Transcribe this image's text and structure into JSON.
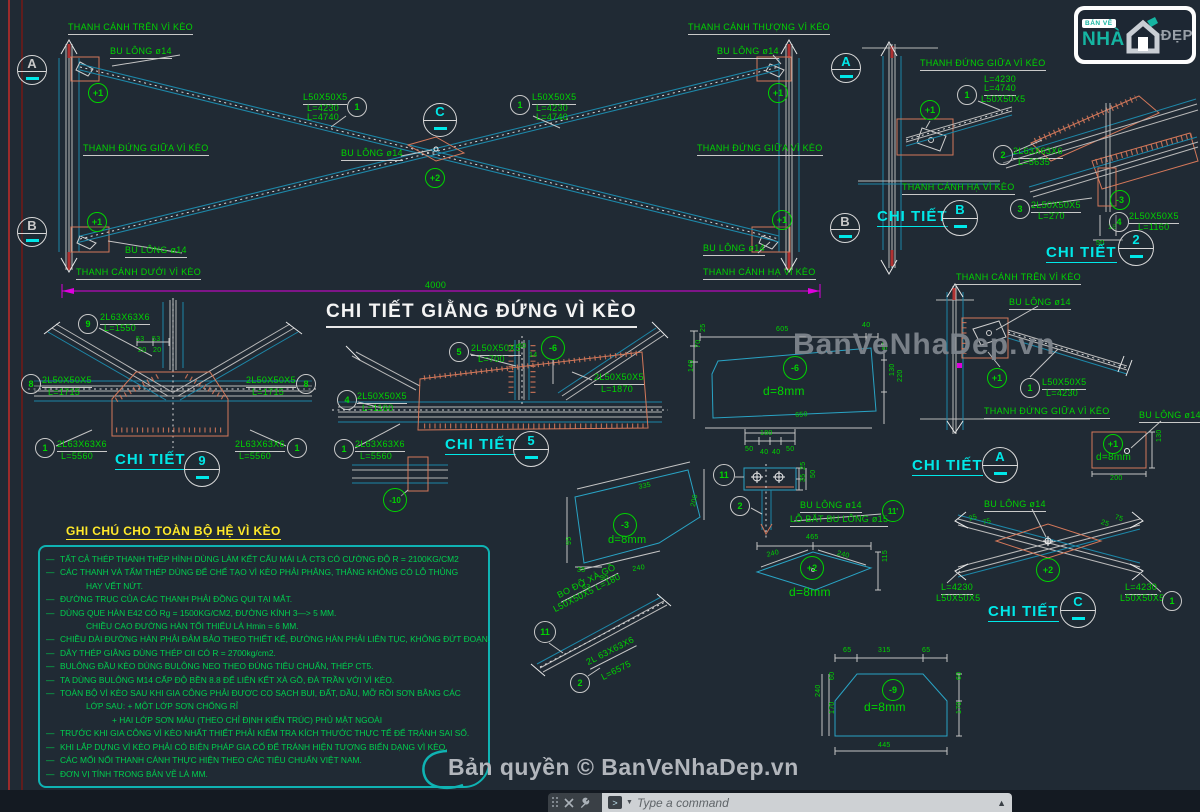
{
  "title": "CHI TIẾT GIẰNG ĐỨNG VÌ KÈO",
  "branding": {
    "watermark": "BanVeNhaDep.vn",
    "copyright": "Bản quyền © BanVeNhaDep.vn",
    "logo": {
      "line1": "BẢN VẼ",
      "line2": "NHÀ",
      "line3": "ĐẸP"
    }
  },
  "app": {
    "command_placeholder": "Type a command"
  },
  "colors": {
    "green": "#00d400",
    "cyan": "#00e8e8",
    "yellow": "#ffe92a",
    "salmon": "#d4785a",
    "magenta": "#e000e0",
    "gray": "#c9c9c9",
    "teal_box": "#0fb3b3",
    "red": "#b13232"
  },
  "notes": {
    "heading": "GHI CHÚ CHO TOÀN BỘ HỆ VÌ KÈO",
    "lines": [
      {
        "d": 1,
        "i": 0,
        "t": "TẤT CẢ THÉP THANH THÉP HÌNH DÙNG LÀM KẾT CẤU MÁI  LÀ CT3 CÓ CƯỜNG ĐỘ R = 2100KG/CM2"
      },
      {
        "d": 1,
        "i": 0,
        "t": "CÁC THANH VÀ TẤM THÉP DÙNG ĐỂ CHẾ TẠO VÌ KÈO PHẢI PHẲNG, THẲNG KHÔNG CÓ LỖ THỦNG"
      },
      {
        "d": 0,
        "i": 1,
        "t": "HAY VẾT NỨT."
      },
      {
        "d": 1,
        "i": 0,
        "t": "ĐƯỜNG TRỤC CỦA CÁC THANH PHẢI ĐỒNG QUI TẠI MẮT."
      },
      {
        "d": 1,
        "i": 0,
        "t": "DÙNG QUE HÀN E42 CÓ Rg = 1500KG/CM2, ĐƯỜNG KÍNH 3—> 5 MM."
      },
      {
        "d": 0,
        "i": 1,
        "t": "CHIỀU CAO ĐƯỜNG HÀN TỐI THIỂU LÀ Hmin = 6 MM."
      },
      {
        "d": 1,
        "i": 0,
        "t": "CHIỀU DÀI ĐƯỜNG HÀN PHẢI ĐẢM BẢO THEO THIẾT KẾ, ĐƯỜNG HÀN PHẢI LIÊN TỤC, KHÔNG ĐỨT ĐOẠN."
      },
      {
        "d": 1,
        "i": 0,
        "t": "DÂY THÉP GIẰNG DÙNG THÉP CII CÓ R = 2700kg/cm2."
      },
      {
        "d": 1,
        "i": 0,
        "t": "BULÔNG ĐẦU KÈO DÙNG BULÔNG NEO THEO ĐÚNG TIÊU CHUẨN, THÉP CT5."
      },
      {
        "d": 1,
        "i": 0,
        "t": "TA DÙNG BULÔNG M14 CẤP ĐỘ BỀN 8.8 ĐỂ LIÊN KẾT XÀ GỒ, ĐÀ TRẦN VỚI VÌ KÈO."
      },
      {
        "d": 1,
        "i": 0,
        "t": "TOÀN BỘ VÌ KÈO SAU KHI GIA CÔNG PHẢI ĐƯỢC CỌ SẠCH BỤI, ĐẤT, DẦU, MỠ RỒI SƠN BẰNG CÁC"
      },
      {
        "d": 0,
        "i": 1,
        "t": "LỚP SAU:  + MỘT LỚP SƠN CHỐNG RỈ"
      },
      {
        "d": 0,
        "i": 2,
        "t": "+ HAI LỚP SƠN MÀU (THEO CHỈ ĐỊNH KIẾN TRÚC) PHỦ MẶT NGOÀI"
      },
      {
        "d": 1,
        "i": 0,
        "t": "TRƯỚC KHI GIA CÔNG VÌ KÈO NHẤT THIẾT PHẢI KIỂM TRA KÍCH THƯỚC THỰC TẾ ĐỂ TRÁNH SAI SỐ."
      },
      {
        "d": 1,
        "i": 0,
        "t": "KHI LẮP DỰNG VÌ KÈO PHẢI CÓ BIỆN PHÁP GIA CỐ ĐỂ TRÁNH HIỆN TƯỢNG BIẾN DẠNG VÌ KÈO."
      },
      {
        "d": 1,
        "i": 0,
        "t": "CÁC MỐI NỐI THANH CÁNH THỰC HIỆN THEO CÁC TIÊU CHUẨN VIỆT NAM."
      },
      {
        "d": 1,
        "i": 0,
        "t": "ĐƠN VỊ TÍNH TRONG BẢN VẼ LÀ MM."
      }
    ]
  },
  "labels": [
    {
      "t": "THANH CÁNH TRÊN VÌ KÈO",
      "x": 68,
      "y": 23,
      "u": 1
    },
    {
      "t": "BU LÔNG ø14",
      "x": 110,
      "y": 47,
      "u": 1
    },
    {
      "t": "L50X50X5",
      "x": 303,
      "y": 93,
      "u": 1
    },
    {
      "t": "L=4230",
      "x": 307,
      "y": 104
    },
    {
      "t": "L=4740",
      "x": 307,
      "y": 113
    },
    {
      "t": "THANH ĐỨNG GIỮA VÌ KÈO",
      "x": 83,
      "y": 144,
      "u": 1
    },
    {
      "t": "BU LÔNG ø14",
      "x": 341,
      "y": 149,
      "u": 1
    },
    {
      "t": "BU LÔNG ø14",
      "x": 125,
      "y": 246,
      "u": 1
    },
    {
      "t": "THANH CÁNH DƯỚI VÌ KÈO",
      "x": 76,
      "y": 268,
      "u": 1
    },
    {
      "t": "THANH CÁNH THƯỢNG VÌ KÈO",
      "x": 688,
      "y": 23,
      "u": 1
    },
    {
      "t": "BU LÔNG ø14",
      "x": 717,
      "y": 47,
      "u": 1
    },
    {
      "t": "L50X50X5",
      "x": 532,
      "y": 93,
      "u": 1
    },
    {
      "t": "L=4230",
      "x": 536,
      "y": 104
    },
    {
      "t": "L=4740",
      "x": 536,
      "y": 113
    },
    {
      "t": "THANH ĐỨNG GIỮA VÌ KÈO",
      "x": 697,
      "y": 144,
      "u": 1
    },
    {
      "t": "BU LÔNG ø14",
      "x": 703,
      "y": 244,
      "u": 1
    },
    {
      "t": "THANH CÁNH HẠ VÌ KÈO",
      "x": 703,
      "y": 268,
      "u": 1
    },
    {
      "t": "4000",
      "x": 425,
      "y": 281
    },
    {
      "t": "THANH ĐỨNG GIỮA VÌ KÈO",
      "x": 920,
      "y": 59,
      "u": 1
    },
    {
      "t": "L=4230",
      "x": 984,
      "y": 75
    },
    {
      "t": "L=4740",
      "x": 984,
      "y": 84,
      "u": 1
    },
    {
      "t": "L50X50X5",
      "x": 981,
      "y": 95
    },
    {
      "t": "THANH CÁNH HẠ VÌ KÈO",
      "x": 902,
      "y": 183,
      "u": 1
    },
    {
      "t": "CHI TIẾT",
      "x": 877,
      "y": 209,
      "c": "cy",
      "s": 15,
      "b": 1,
      "u": 2
    },
    {
      "t": "2L63X63X6",
      "x": 1013,
      "y": 147,
      "u": 1
    },
    {
      "t": "L=5635",
      "x": 1018,
      "y": 158
    },
    {
      "t": "2L50X50X5",
      "x": 1031,
      "y": 201,
      "u": 1
    },
    {
      "t": "L=270",
      "x": 1038,
      "y": 212
    },
    {
      "t": "2L50X50X5",
      "x": 1129,
      "y": 212,
      "u": 1
    },
    {
      "t": "L=1160",
      "x": 1138,
      "y": 223
    },
    {
      "t": "18",
      "x": 1108,
      "y": 224,
      "s": 7
    },
    {
      "t": "50",
      "x": 1096,
      "y": 240,
      "s": 7
    },
    {
      "t": "CHI TIẾT",
      "x": 1046,
      "y": 245,
      "c": "cy",
      "s": 15,
      "b": 1,
      "u": 2
    },
    {
      "t": "2L63X63X6",
      "x": 100,
      "y": 313,
      "u": 1
    },
    {
      "t": "L=1550",
      "x": 104,
      "y": 324
    },
    {
      "t": "53",
      "x": 136,
      "y": 336,
      "s": 7
    },
    {
      "t": "53",
      "x": 152,
      "y": 336,
      "s": 7
    },
    {
      "t": "20",
      "x": 138,
      "y": 347,
      "s": 7
    },
    {
      "t": "20",
      "x": 153,
      "y": 347,
      "s": 7
    },
    {
      "t": "2L50X50X5",
      "x": 42,
      "y": 376,
      "u": 1
    },
    {
      "t": "L=1715",
      "x": 48,
      "y": 388
    },
    {
      "t": "2L50X50X5",
      "x": 246,
      "y": 376,
      "u": 1
    },
    {
      "t": "L=1715",
      "x": 252,
      "y": 388
    },
    {
      "t": "2L63X63X6",
      "x": 57,
      "y": 440,
      "u": 1
    },
    {
      "t": "L=5560",
      "x": 61,
      "y": 452
    },
    {
      "t": "2L63X63X6",
      "x": 235,
      "y": 440,
      "u": 1
    },
    {
      "t": "L=5560",
      "x": 239,
      "y": 452
    },
    {
      "t": "CHI TIẾT",
      "x": 115,
      "y": 452,
      "c": "cy",
      "s": 15,
      "b": 1,
      "u": 2
    },
    {
      "t": "2L50X50X5",
      "x": 471,
      "y": 344,
      "u": 1
    },
    {
      "t": "L=700",
      "x": 478,
      "y": 355
    },
    {
      "t": "2L50X50X5",
      "x": 594,
      "y": 373,
      "u": 1
    },
    {
      "t": "L=1870",
      "x": 601,
      "y": 385
    },
    {
      "t": "2L50X50X5",
      "x": 357,
      "y": 392,
      "u": 1
    },
    {
      "t": "L=1160",
      "x": 362,
      "y": 404
    },
    {
      "t": "2L63X63X6",
      "x": 355,
      "y": 440,
      "u": 1
    },
    {
      "t": "L=5560",
      "x": 360,
      "y": 452
    },
    {
      "t": "CHI TIẾT",
      "x": 445,
      "y": 437,
      "c": "cy",
      "s": 15,
      "b": 1,
      "u": 2
    },
    {
      "t": "60",
      "x": 518,
      "y": 343,
      "s": 7
    },
    {
      "t": "14",
      "x": 529,
      "y": 352,
      "s": 7
    },
    {
      "t": "d=8mm",
      "x": 608,
      "y": 535,
      "s": 11
    },
    {
      "t": "335",
      "x": 638,
      "y": 484,
      "s": 7,
      "r": -11
    },
    {
      "t": "240",
      "x": 632,
      "y": 566,
      "s": 7,
      "r": -9
    },
    {
      "t": "90",
      "x": 600,
      "y": 575,
      "s": 7
    },
    {
      "t": "35",
      "x": 577,
      "y": 567,
      "s": 7
    },
    {
      "t": "63",
      "x": 582,
      "y": 584,
      "s": 7
    },
    {
      "t": "95",
      "x": 566,
      "y": 545,
      "s": 7,
      "r": -90
    },
    {
      "t": "200",
      "x": 690,
      "y": 506,
      "s": 7,
      "r": -78
    },
    {
      "t": "BO ĐỠ XÀ GỒ",
      "x": 556,
      "y": 592,
      "r": -27,
      "u": 1
    },
    {
      "t": "L50X50X5 L=180",
      "x": 552,
      "y": 606,
      "r": -27
    },
    {
      "t": "2L 63X63X6",
      "x": 585,
      "y": 659,
      "r": -27,
      "u": 1
    },
    {
      "t": "L=6575",
      "x": 600,
      "y": 674,
      "r": -27
    },
    {
      "t": "180",
      "x": 760,
      "y": 430,
      "s": 7
    },
    {
      "t": "50",
      "x": 745,
      "y": 446,
      "s": 7
    },
    {
      "t": "40",
      "x": 760,
      "y": 449,
      "s": 7
    },
    {
      "t": "40",
      "x": 772,
      "y": 449,
      "s": 7
    },
    {
      "t": "50",
      "x": 786,
      "y": 446,
      "s": 7
    },
    {
      "t": "25",
      "x": 800,
      "y": 470,
      "s": 7,
      "r": -90
    },
    {
      "t": "35",
      "x": 800,
      "y": 482,
      "s": 7,
      "r": -90
    },
    {
      "t": "50",
      "x": 810,
      "y": 478,
      "s": 7,
      "r": -90
    },
    {
      "t": "BU LÔNG ø14",
      "x": 800,
      "y": 501,
      "u": 1
    },
    {
      "t": "LỖ BẮT BU LÔNG ø15",
      "x": 790,
      "y": 515,
      "u": 1
    },
    {
      "t": "605",
      "x": 776,
      "y": 326,
      "s": 7
    },
    {
      "t": "40",
      "x": 862,
      "y": 322,
      "s": 7
    },
    {
      "t": "25",
      "x": 700,
      "y": 332,
      "s": 7,
      "r": -90
    },
    {
      "t": "70",
      "x": 695,
      "y": 348,
      "s": 7,
      "r": -90
    },
    {
      "t": "140",
      "x": 688,
      "y": 372,
      "s": 7,
      "r": -90
    },
    {
      "t": "55",
      "x": 882,
      "y": 350,
      "s": 7,
      "r": -90
    },
    {
      "t": "130",
      "x": 889,
      "y": 376,
      "s": 7,
      "r": -90
    },
    {
      "t": "220",
      "x": 897,
      "y": 382,
      "s": 7,
      "r": -90
    },
    {
      "t": "d=8mm",
      "x": 763,
      "y": 385,
      "s": 12
    },
    {
      "t": "650",
      "x": 795,
      "y": 412,
      "s": 7,
      "r": -4
    },
    {
      "t": "465",
      "x": 806,
      "y": 534,
      "s": 7
    },
    {
      "t": "240",
      "x": 766,
      "y": 552,
      "s": 7,
      "r": -14
    },
    {
      "t": "240",
      "x": 838,
      "y": 550,
      "s": 7,
      "r": 14
    },
    {
      "t": "115",
      "x": 882,
      "y": 562,
      "s": 7,
      "r": -90
    },
    {
      "t": "d=8mm",
      "x": 789,
      "y": 586,
      "s": 12
    },
    {
      "t": "65",
      "x": 843,
      "y": 647,
      "s": 7
    },
    {
      "t": "315",
      "x": 878,
      "y": 647,
      "s": 7
    },
    {
      "t": "65",
      "x": 922,
      "y": 647,
      "s": 7
    },
    {
      "t": "240",
      "x": 815,
      "y": 697,
      "s": 7,
      "r": -90
    },
    {
      "t": "60",
      "x": 829,
      "y": 680,
      "s": 7,
      "r": -90
    },
    {
      "t": "170",
      "x": 829,
      "y": 714,
      "s": 7,
      "r": -90
    },
    {
      "t": "60",
      "x": 956,
      "y": 680,
      "s": 7,
      "r": -90
    },
    {
      "t": "170",
      "x": 956,
      "y": 714,
      "s": 7,
      "r": -90
    },
    {
      "t": "445",
      "x": 878,
      "y": 742,
      "s": 7
    },
    {
      "t": "d=8mm",
      "x": 864,
      "y": 701,
      "s": 12
    },
    {
      "t": "THANH CÁNH TRÊN VÌ KÈO",
      "x": 956,
      "y": 273,
      "u": 1
    },
    {
      "t": "BU LÔNG ø14",
      "x": 1009,
      "y": 298,
      "u": 1
    },
    {
      "t": "L50X50X5",
      "x": 1042,
      "y": 378,
      "u": 1
    },
    {
      "t": "L=4230",
      "x": 1046,
      "y": 389
    },
    {
      "t": "THANH ĐỨNG GIỮA VÌ KÈO",
      "x": 984,
      "y": 407,
      "u": 1
    },
    {
      "t": "CHI TIẾT",
      "x": 912,
      "y": 458,
      "c": "cy",
      "s": 15,
      "b": 1,
      "u": 2
    },
    {
      "t": "BU LÔNG ø14",
      "x": 1139,
      "y": 411,
      "u": 1
    },
    {
      "t": "d=8mm",
      "x": 1096,
      "y": 453,
      "s": 10
    },
    {
      "t": "130",
      "x": 1156,
      "y": 442,
      "s": 7,
      "r": -90
    },
    {
      "t": "200",
      "x": 1110,
      "y": 475,
      "s": 7
    },
    {
      "t": "BU LÔNG ø14",
      "x": 984,
      "y": 500,
      "u": 1
    },
    {
      "t": "25",
      "x": 968,
      "y": 516,
      "s": 7,
      "r": -17
    },
    {
      "t": "75",
      "x": 982,
      "y": 520,
      "s": 7,
      "r": -17
    },
    {
      "t": "25",
      "x": 1102,
      "y": 519,
      "s": 7,
      "r": 17
    },
    {
      "t": "75",
      "x": 1116,
      "y": 514,
      "s": 7,
      "r": 17
    },
    {
      "t": "L=4230",
      "x": 941,
      "y": 583,
      "u": 1
    },
    {
      "t": "L50X50X5",
      "x": 936,
      "y": 594
    },
    {
      "t": "L=4230",
      "x": 1125,
      "y": 583,
      "u": 1
    },
    {
      "t": "L50X50X5",
      "x": 1120,
      "y": 594
    },
    {
      "t": "CHI TIẾT",
      "x": 988,
      "y": 604,
      "c": "cy",
      "s": 15,
      "b": 1,
      "u": 2
    }
  ],
  "callouts": [
    {
      "k": "sec",
      "t": "A",
      "x": 32,
      "y": 70,
      "r": 15,
      "tc": "gr"
    },
    {
      "k": "sec",
      "t": "B",
      "x": 32,
      "y": 232,
      "r": 15,
      "tc": "gr"
    },
    {
      "k": "sec",
      "t": "C",
      "x": 440,
      "y": 120,
      "r": 17,
      "tc": "cy"
    },
    {
      "k": "sec",
      "t": "A",
      "x": 846,
      "y": 68,
      "r": 15,
      "tc": "cy"
    },
    {
      "k": "sec",
      "t": "B",
      "x": 845,
      "y": 228,
      "r": 15,
      "tc": "gr"
    },
    {
      "k": "sec",
      "t": "B",
      "x": 960,
      "y": 218,
      "r": 18,
      "tc": "cy"
    },
    {
      "k": "sec",
      "t": "2",
      "x": 1136,
      "y": 248,
      "r": 18,
      "tc": "cy"
    },
    {
      "k": "sec",
      "t": "9",
      "x": 202,
      "y": 469,
      "r": 18,
      "tc": "cy"
    },
    {
      "k": "sec",
      "t": "5",
      "x": 531,
      "y": 449,
      "r": 18,
      "tc": "cy"
    },
    {
      "k": "sec",
      "t": "A",
      "x": 1000,
      "y": 465,
      "r": 18,
      "tc": "cy"
    },
    {
      "k": "sec",
      "t": "C",
      "x": 1078,
      "y": 610,
      "r": 18,
      "tc": "cy"
    },
    {
      "k": "part",
      "t": "1",
      "x": 357,
      "y": 107
    },
    {
      "k": "part",
      "t": "1",
      "x": 520,
      "y": 105
    },
    {
      "k": "part",
      "t": "+1",
      "x": 98,
      "y": 93
    },
    {
      "k": "part",
      "t": "+1",
      "x": 97,
      "y": 222
    },
    {
      "k": "part",
      "t": "+1",
      "x": 778,
      "y": 93
    },
    {
      "k": "part",
      "t": "+1",
      "x": 782,
      "y": 220
    },
    {
      "k": "part",
      "t": "+2",
      "x": 435,
      "y": 178
    },
    {
      "k": "part",
      "t": "1",
      "x": 967,
      "y": 95
    },
    {
      "k": "part",
      "t": "+1",
      "x": 930,
      "y": 110
    },
    {
      "k": "part",
      "t": "2",
      "x": 1003,
      "y": 155
    },
    {
      "k": "part",
      "t": "3",
      "x": 1020,
      "y": 209
    },
    {
      "k": "part",
      "t": "-3",
      "x": 1120,
      "y": 200
    },
    {
      "k": "part",
      "t": "4",
      "x": 1119,
      "y": 222
    },
    {
      "k": "part",
      "t": "9",
      "x": 88,
      "y": 324
    },
    {
      "k": "part",
      "t": "8",
      "x": 31,
      "y": 384
    },
    {
      "k": "part",
      "t": "8",
      "x": 306,
      "y": 384
    },
    {
      "k": "part",
      "t": "1",
      "x": 45,
      "y": 448
    },
    {
      "k": "part",
      "t": "1",
      "x": 297,
      "y": 448
    },
    {
      "k": "part",
      "t": "5",
      "x": 459,
      "y": 352
    },
    {
      "k": "part",
      "t": "-6",
      "x": 553,
      "y": 348,
      "r": 12
    },
    {
      "k": "part",
      "t": "4",
      "x": 347,
      "y": 400
    },
    {
      "k": "part",
      "t": "1",
      "x": 344,
      "y": 449
    },
    {
      "k": "part",
      "t": "-10",
      "x": 395,
      "y": 500,
      "r": 12
    },
    {
      "k": "part",
      "t": "-3",
      "x": 625,
      "y": 525,
      "r": 12
    },
    {
      "k": "part",
      "t": "11",
      "x": 545,
      "y": 632,
      "r": 11
    },
    {
      "k": "part",
      "t": "2",
      "x": 580,
      "y": 683
    },
    {
      "k": "part",
      "t": "11",
      "x": 724,
      "y": 475,
      "r": 11
    },
    {
      "k": "part",
      "t": "2",
      "x": 740,
      "y": 506
    },
    {
      "k": "part",
      "t": "11'",
      "x": 893,
      "y": 511,
      "r": 11
    },
    {
      "k": "part",
      "t": "-6",
      "x": 795,
      "y": 368,
      "r": 12
    },
    {
      "k": "part",
      "t": "+2",
      "x": 812,
      "y": 568,
      "r": 12
    },
    {
      "k": "part",
      "t": "-9",
      "x": 893,
      "y": 690,
      "r": 11
    },
    {
      "k": "part",
      "t": "+1",
      "x": 997,
      "y": 378
    },
    {
      "k": "part",
      "t": "1",
      "x": 1030,
      "y": 388
    },
    {
      "k": "part",
      "t": "+1",
      "x": 1113,
      "y": 444
    },
    {
      "k": "part",
      "t": "+2",
      "x": 1048,
      "y": 570,
      "r": 12
    },
    {
      "k": "part",
      "t": "1",
      "x": 1172,
      "y": 601
    }
  ]
}
